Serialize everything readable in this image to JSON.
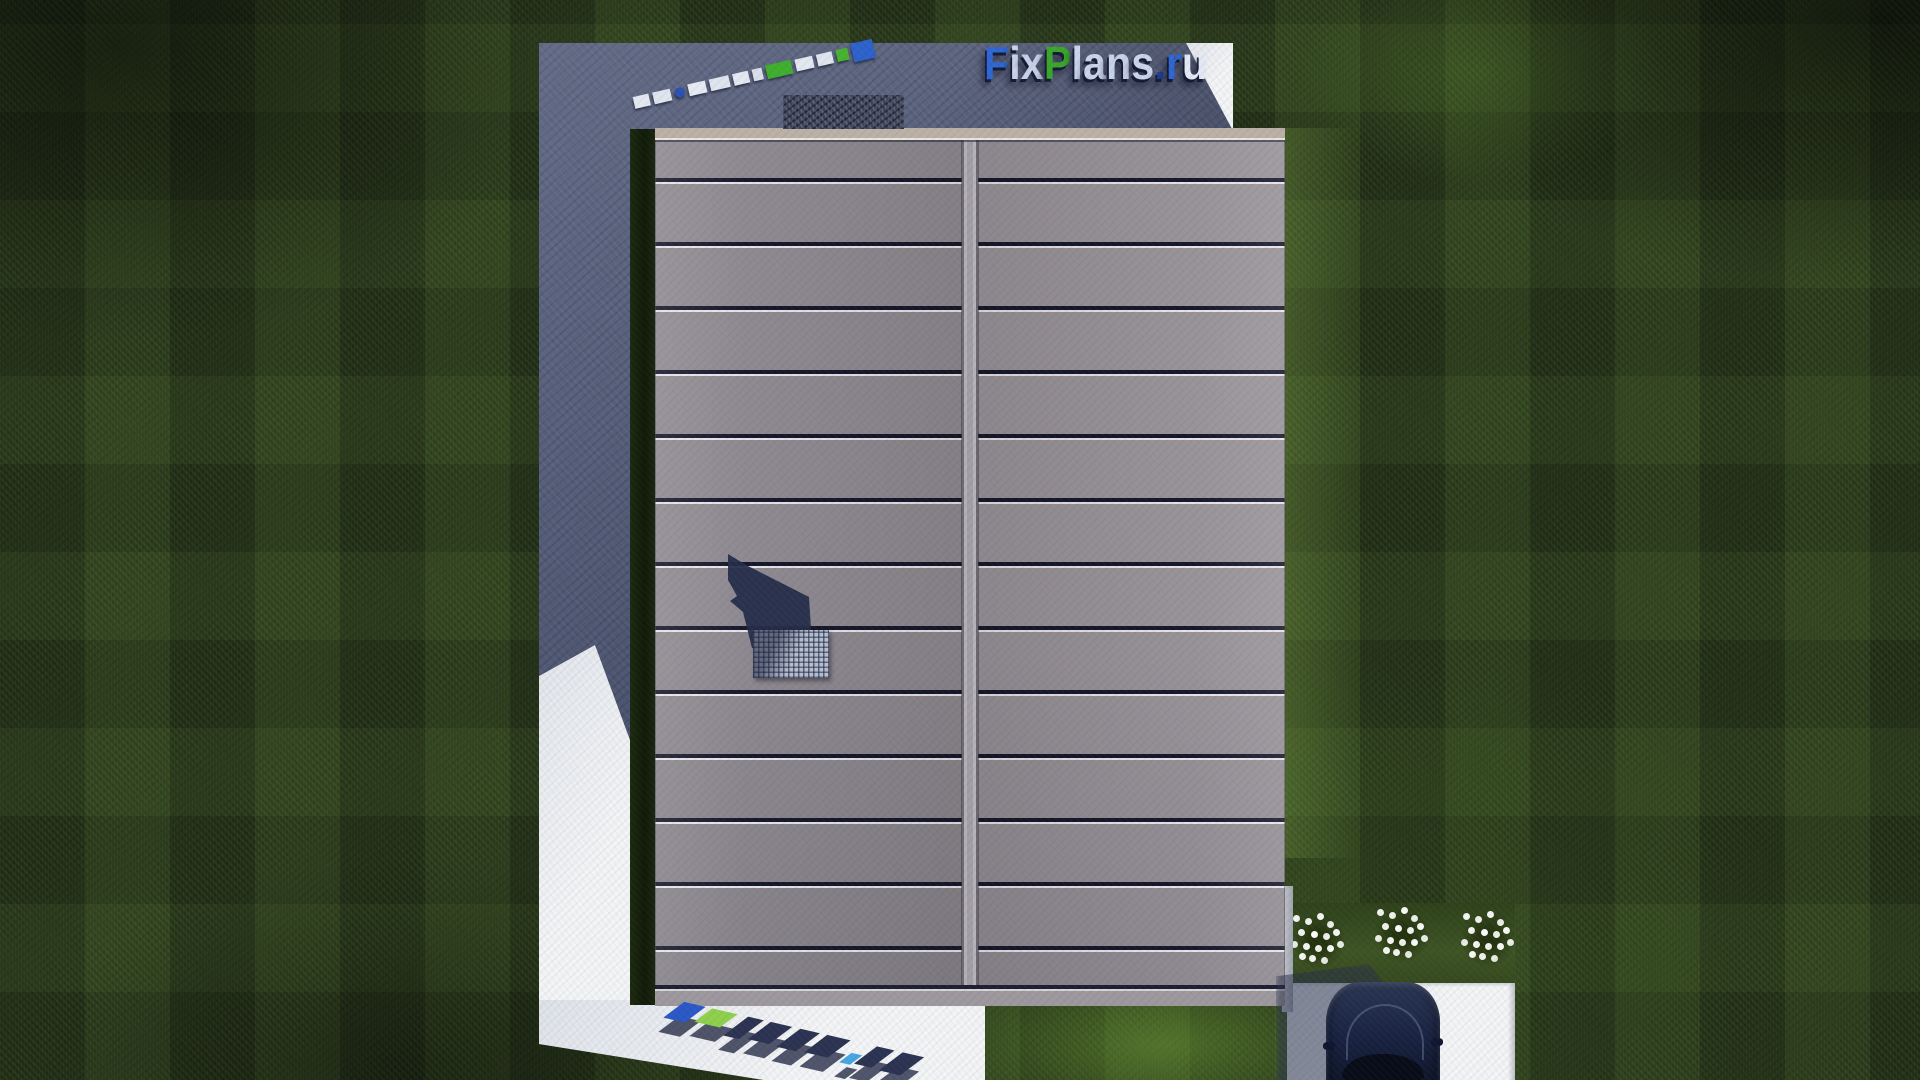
{
  "scene": {
    "type": "3d-architectural-render-top-view",
    "description": "Aerial top-down render of a house with a gray standing-seam double-pitch roof on a dark lawn, shadowed concrete yard, sunlit white walkway and driveway, parked dark-blue car and white flower bushes",
    "elements": [
      "lawn",
      "concrete-yard-in-shadow",
      "walkway",
      "house-roof",
      "roof-ridge",
      "chimney",
      "chimney-grate",
      "driveway",
      "car",
      "flower-bushes",
      "fence-post"
    ]
  },
  "branding": {
    "logo_text": "FixPlans.ru",
    "letters": [
      {
        "char": "F",
        "color": "#2f66d2"
      },
      {
        "char": "i",
        "color": "#cbd5eb"
      },
      {
        "char": "x",
        "color": "#c6d0e8"
      },
      {
        "char": "P",
        "color": "#3aa52c"
      },
      {
        "char": "l",
        "color": "#cbd5eb"
      },
      {
        "char": "a",
        "color": "#c9d3ea"
      },
      {
        "char": "n",
        "color": "#c7d1e8"
      },
      {
        "char": "s",
        "color": "#c9d3ea"
      },
      {
        "char": ".",
        "color": "#1e3d96"
      },
      {
        "char": "r",
        "color": "#2f66d2"
      },
      {
        "char": "u",
        "color": "#e2e8f4"
      }
    ],
    "watermark_top_left": "FixPlans.ru",
    "watermark_bottom": "FixPlans.ru"
  },
  "palette": {
    "grass_dark": "#27371b",
    "grass_sunlit": "#3f5a26",
    "concrete_shadow": "#555d78",
    "pavement_white": "#e9ebee",
    "roof_left": "#8e8990",
    "roof_right": "#989299",
    "roof_seam_dark": "#15182a",
    "ridge_gray": "#a29ea5",
    "fascia_beige": "#bbb0a6",
    "logo_blue": "#2f66d2",
    "logo_green": "#3aa52c",
    "logo_light": "#cbd5eb",
    "car_navy": "#182240",
    "chimney_grate": "#b6bfd1"
  }
}
